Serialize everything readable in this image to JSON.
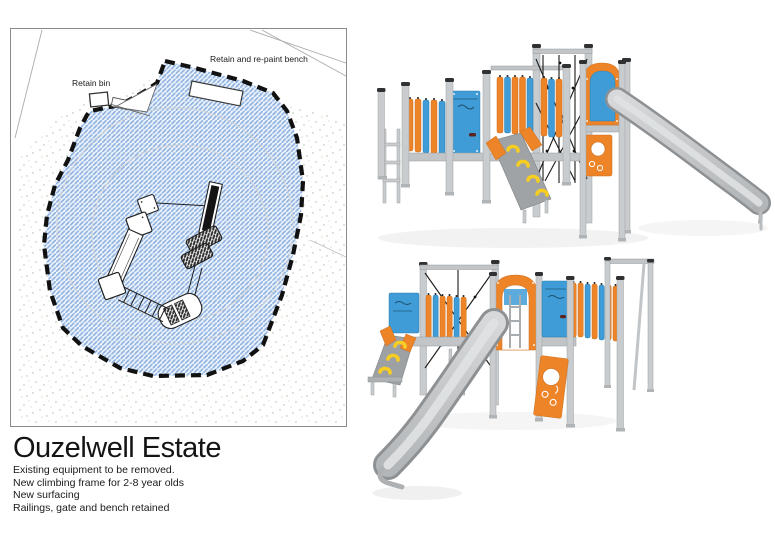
{
  "title_block": {
    "title": "Ouzelwell Estate",
    "notes": [
      "Existing equipment to be removed.",
      "New climbing frame for 2-8 year olds",
      "New surfacing",
      "Railings, gate and bench retained"
    ]
  },
  "site_plan": {
    "annotations": {
      "bin": "Retain bin",
      "bench": "Retain and re-paint bench"
    }
  },
  "palette": {
    "play_orange": "#EE8428",
    "play_blue": "#3F9CD6",
    "steel_grey": "#C9CCCE",
    "steel_shade": "#9EA1A3",
    "post_cap": "#2F3133",
    "grip_yellow": "#F6CD23",
    "net_black": "#1A1A1A",
    "surfacing_hatch": "#8FB2E0",
    "boundary": "#111111",
    "stipple_green": "#A6C49E"
  }
}
